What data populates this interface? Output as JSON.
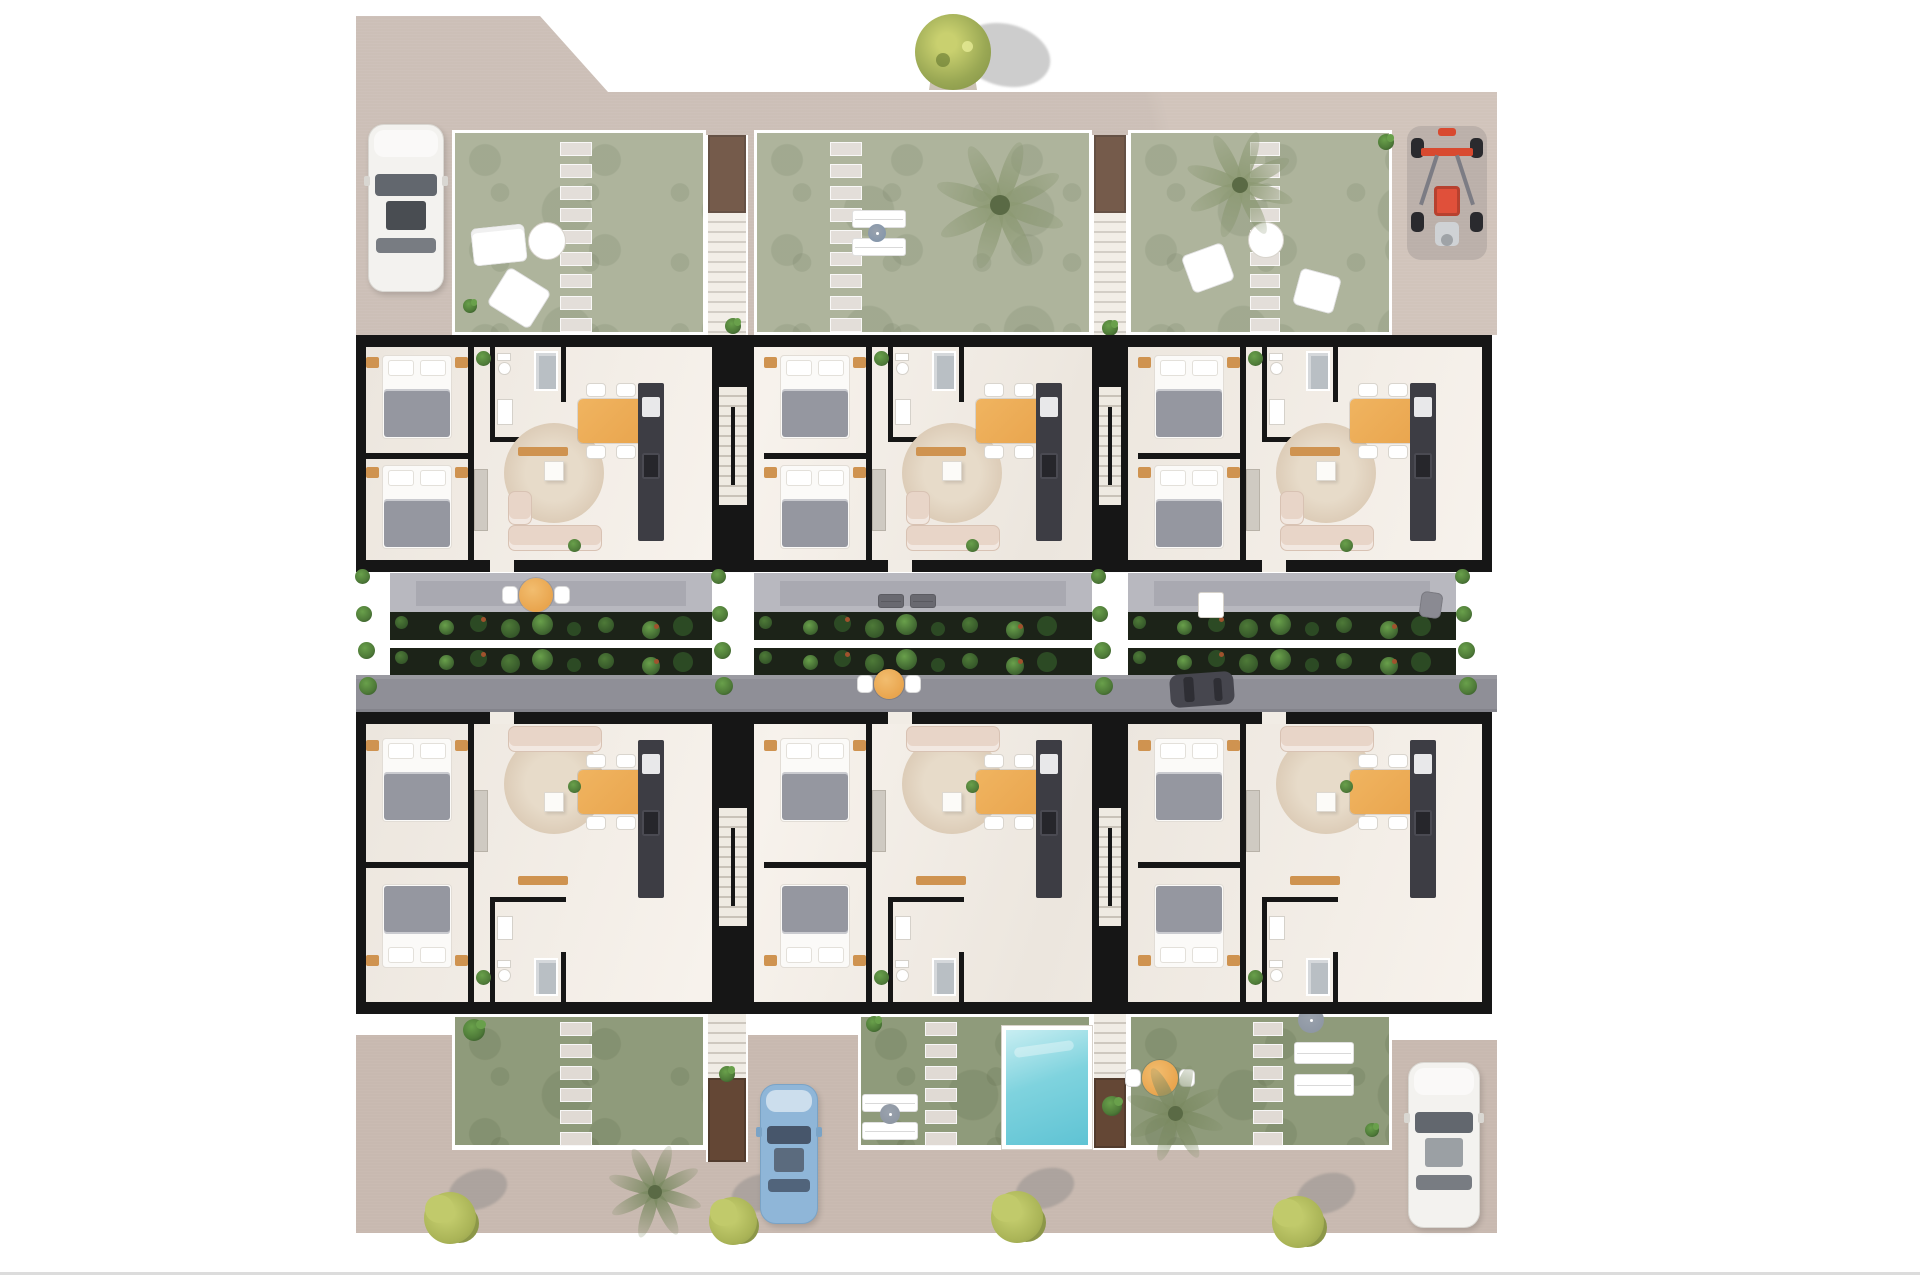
{
  "meta": {
    "description": "aerial-3d-floor-plan-render-of-two-row-residential-complex",
    "canvas": {
      "w": 1920,
      "h": 1280,
      "bg": "#ffffff"
    }
  },
  "palette": {
    "pavementTop": "#c6b6ab",
    "pavementBottom": "#c2b2a7",
    "gardenTop": "#9aa284",
    "gardenBottom": "#83906c",
    "gardenSpot": "rgba(45,62,28,0.14)",
    "stone": "#ddd6d0",
    "wall": "#161616",
    "floorA": "#ece6de",
    "floorB": "#f7f2ec",
    "terrace": "#b8b8bf",
    "terraceInner": "#a9a9b1",
    "street": "#8f8f97",
    "planterBase": "#1c2318",
    "plant1": "#4e7a38",
    "plant2": "#69a04b",
    "plant3": "#2c4a24",
    "plantAccent": "#a0522d",
    "poolHi": "#c8eef2",
    "poolMid": "#7fd3de",
    "poolLo": "#5fc3d4",
    "orange": "#e9a54e",
    "rug": "#dbcab5",
    "rugHi": "#e7dbc9",
    "sofa": "#e8d5c8",
    "blanket": "#9597a0",
    "sheet": "#fbfaf8",
    "nightstand": "#cf9350",
    "kitchen": "#3d3d44",
    "brown": "#53331f",
    "brownDark": "#3f2617",
    "tread": "#efeae2",
    "treadLine": "#c9c2b8",
    "carWhite": "#f3f2ef",
    "carBlue": "#8fb6d8",
    "carDark": "#46464e",
    "glass": "#62676e",
    "glassDark": "#494d52",
    "buggyRed": "#d84a30",
    "buggyFrame": "#7c7c84",
    "palmTop": "#8d9a74",
    "palmBottom": "#7b8a62",
    "palmCore": "#5a6a45",
    "bushMain": "#aab457",
    "bushHi": "#c1ca6b",
    "bushLo": "#8c9748",
    "treeHi": "#c9d06f",
    "treeMid": "#9aa854",
    "treeLo": "#7e8e44",
    "shadow": "rgba(130,130,130,0.40)",
    "washTop": "rgba(255,255,255,0.20)",
    "washBottom": "rgba(255,255,255,0.10)",
    "white": "#ffffff",
    "loungerGray": "#696970",
    "parasolA": "#9aa2ad",
    "parasolB": "#6f7780"
  },
  "scene": {
    "pavements": [
      {
        "name": "pavement-top",
        "color": "#c6b6ab",
        "points": "356,16 540,16 608,92 1497,92 1497,335 356,335"
      },
      {
        "name": "pavement-bottom",
        "color": "#c2b2a7",
        "points": "356,1035 452,1035 452,1150 748,1150 748,1035 858,1035 858,1150 1392,1150 1392,1040 1497,1040 1497,1233 356,1233"
      }
    ],
    "washes": [
      {
        "name": "sun-wash-top",
        "x": 350,
        "y": 10,
        "w": 1155,
        "h": 330,
        "color": "rgba(255,255,255,0.20)"
      },
      {
        "name": "sun-wash-bottom",
        "x": 350,
        "y": 1014,
        "w": 1155,
        "h": 222,
        "color": "rgba(255,255,255,0.10)"
      }
    ],
    "gardens": [
      {
        "name": "garden-top-1",
        "x": 452,
        "y": 130,
        "w": 254,
        "h": 205,
        "tone": "top",
        "stones": {
          "x": 560,
          "w": 32,
          "y0": 142,
          "count": 9,
          "sh": 14,
          "gap": 8
        }
      },
      {
        "name": "garden-top-2",
        "x": 754,
        "y": 130,
        "w": 338,
        "h": 205,
        "tone": "top",
        "stones": {
          "x": 830,
          "w": 32,
          "y0": 142,
          "count": 9,
          "sh": 14,
          "gap": 8
        }
      },
      {
        "name": "garden-top-3",
        "x": 1128,
        "y": 130,
        "w": 264,
        "h": 205,
        "tone": "top",
        "stones": {
          "x": 1250,
          "w": 30,
          "y0": 142,
          "count": 9,
          "sh": 14,
          "gap": 8
        }
      },
      {
        "name": "garden-bottom-1",
        "x": 452,
        "y": 1014,
        "w": 254,
        "h": 134,
        "tone": "bottom",
        "stones": {
          "x": 560,
          "w": 32,
          "y0": 1022,
          "count": 6,
          "sh": 14,
          "gap": 8
        }
      },
      {
        "name": "garden-bottom-2",
        "x": 858,
        "y": 1014,
        "w": 234,
        "h": 134,
        "tone": "bottom",
        "stones": {
          "x": 925,
          "w": 32,
          "y0": 1022,
          "count": 6,
          "sh": 14,
          "gap": 8
        }
      },
      {
        "name": "garden-bottom-3",
        "x": 1128,
        "y": 1014,
        "w": 264,
        "h": 134,
        "tone": "bottom",
        "stones": {
          "x": 1253,
          "w": 30,
          "y0": 1022,
          "count": 6,
          "sh": 14,
          "gap": 8
        }
      }
    ],
    "stairs": [
      {
        "name": "stairs-top-left",
        "x": 706,
        "w": 42,
        "landing": {
          "y": 135,
          "h": 78
        },
        "treads": {
          "y": 213,
          "h": 122
        }
      },
      {
        "name": "stairs-top-right",
        "x": 1092,
        "w": 36,
        "landing": {
          "y": 135,
          "h": 78
        },
        "treads": {
          "y": 213,
          "h": 122
        }
      },
      {
        "name": "stairs-bottom-left",
        "x": 706,
        "w": 42,
        "treads": {
          "y": 1014,
          "h": 64
        },
        "landing": {
          "y": 1078,
          "h": 84
        }
      },
      {
        "name": "stairs-bottom-right",
        "x": 1092,
        "w": 36,
        "treads": {
          "y": 1014,
          "h": 64
        },
        "landing": {
          "y": 1078,
          "h": 70
        }
      }
    ],
    "pool": {
      "name": "pool",
      "x": 1006,
      "y": 1030,
      "w": 82,
      "h": 115,
      "rim": 4
    },
    "garden_props": [
      {
        "type": "sofa_small",
        "name": "garden-sofa",
        "x": 472,
        "y": 226,
        "w": 54,
        "h": 38,
        "rot": -6
      },
      {
        "type": "table_round_white",
        "name": "garden-table",
        "cx": 547,
        "cy": 241,
        "d": 38
      },
      {
        "type": "chair",
        "name": "garden-chair",
        "x": 494,
        "y": 276,
        "w": 50,
        "h": 44,
        "rot": 32
      },
      {
        "type": "plant",
        "name": "garden-shrub",
        "cx": 470,
        "cy": 306,
        "d": 14
      },
      {
        "type": "lounger",
        "name": "sun-lounger",
        "x": 852,
        "y": 210,
        "w": 54,
        "h": 18
      },
      {
        "type": "lounger",
        "name": "sun-lounger",
        "x": 852,
        "y": 238,
        "w": 54,
        "h": 18
      },
      {
        "type": "parasol",
        "name": "parasol",
        "cx": 877,
        "cy": 233,
        "d": 18,
        "color": "#7d92aa"
      },
      {
        "type": "table_round_white",
        "name": "garden-table",
        "cx": 1266,
        "cy": 240,
        "d": 36
      },
      {
        "type": "chair",
        "name": "garden-chair",
        "x": 1186,
        "y": 248,
        "w": 44,
        "h": 40,
        "rot": -20
      },
      {
        "type": "chair",
        "name": "garden-chair",
        "x": 1296,
        "y": 272,
        "w": 42,
        "h": 38,
        "rot": 15
      },
      {
        "type": "plant",
        "name": "garden-shrub",
        "cx": 1386,
        "cy": 142,
        "d": 16
      },
      {
        "type": "plant",
        "name": "entry-plant",
        "cx": 733,
        "cy": 326,
        "d": 16
      },
      {
        "type": "plant",
        "name": "entry-plant",
        "cx": 1110,
        "cy": 328,
        "d": 16
      },
      {
        "type": "lounger",
        "name": "sun-lounger",
        "x": 862,
        "y": 1094,
        "w": 56,
        "h": 18
      },
      {
        "type": "lounger",
        "name": "sun-lounger",
        "x": 862,
        "y": 1122,
        "w": 56,
        "h": 18
      },
      {
        "type": "parasol",
        "name": "parasol",
        "cx": 890,
        "cy": 1114,
        "d": 20,
        "color": "#8a93a0"
      },
      {
        "type": "plant",
        "name": "garden-shrub",
        "cx": 474,
        "cy": 1030,
        "d": 22
      },
      {
        "type": "plant",
        "name": "garden-shrub",
        "cx": 874,
        "cy": 1024,
        "d": 16
      },
      {
        "type": "parasol",
        "name": "parasol",
        "cx": 1311,
        "cy": 1020,
        "d": 26,
        "color": "#8a93a0"
      },
      {
        "type": "lounger",
        "name": "sun-lounger",
        "x": 1294,
        "y": 1042,
        "w": 60,
        "h": 22
      },
      {
        "type": "lounger",
        "name": "sun-lounger",
        "x": 1294,
        "y": 1074,
        "w": 60,
        "h": 22
      },
      {
        "type": "round_table_set",
        "name": "patio-table",
        "cx": 1160,
        "cy": 1078,
        "d": 36,
        "chairs": 2
      },
      {
        "type": "plant",
        "name": "stair-plant",
        "cx": 1112,
        "cy": 1106,
        "d": 20
      },
      {
        "type": "plant",
        "name": "stair-plant",
        "cx": 727,
        "cy": 1074,
        "d": 16
      },
      {
        "type": "plant",
        "name": "garden-shrub",
        "cx": 1372,
        "cy": 1130,
        "d": 14
      }
    ],
    "trees": [
      {
        "type": "roundtree",
        "name": "tree",
        "cx": 953,
        "cy": 52,
        "r": 38
      },
      {
        "type": "palm",
        "name": "palm-tree",
        "cx": 1000,
        "cy": 205,
        "r": 66,
        "tone": "top"
      },
      {
        "type": "palm",
        "name": "palm-tree",
        "cx": 1240,
        "cy": 185,
        "r": 55,
        "tone": "top"
      },
      {
        "type": "palm",
        "name": "palm-tree",
        "cx": 655,
        "cy": 1192,
        "r": 48,
        "tone": "bottom"
      },
      {
        "type": "palm",
        "name": "palm-tree",
        "cx": 1175,
        "cy": 1113,
        "r": 50,
        "tone": "bottom"
      },
      {
        "type": "bush",
        "name": "street-bush",
        "cx": 450,
        "cy": 1218,
        "r": 26
      },
      {
        "type": "bush",
        "name": "street-bush",
        "cx": 733,
        "cy": 1221,
        "r": 24
      },
      {
        "type": "bush",
        "name": "street-bush",
        "cx": 1017,
        "cy": 1217,
        "r": 26
      },
      {
        "type": "bush",
        "name": "street-bush",
        "cx": 1298,
        "cy": 1222,
        "r": 26
      }
    ],
    "cars": [
      {
        "type": "sedan",
        "name": "car-white-top",
        "x": 368,
        "y": 124,
        "w": 76,
        "h": 168,
        "body": "#f3f2ef",
        "edge": "#d9d7d2",
        "glass": "#62676e",
        "sunroof": "#494d52",
        "when": "top"
      },
      {
        "type": "buggy",
        "name": "quad-buggy",
        "x": 1411,
        "y": 128,
        "w": 72,
        "h": 128,
        "when": "top"
      },
      {
        "type": "sedan",
        "name": "car-blue-bottom",
        "x": 760,
        "y": 1084,
        "w": 58,
        "h": 140,
        "body": "#8fb6d8",
        "edge": "#7aa3c6",
        "glass": "#47566b",
        "sunroof": "#5b6b7e",
        "when": "bottom"
      },
      {
        "type": "sedan",
        "name": "car-white-bottom",
        "x": 1408,
        "y": 1062,
        "w": 72,
        "h": 166,
        "body": "#f3f2ef",
        "edge": "#d9d7d2",
        "glass": "#62676e",
        "sunroof": "#9ba0a4",
        "when": "bottom"
      }
    ],
    "building": {
      "rows": [
        {
          "name": "units-row-upper",
          "y": 335,
          "h": 237,
          "wallH": 12,
          "floorY": 347,
          "floorH": 213,
          "template": "upper",
          "units": [
            {
              "x": 356,
              "w": 356
            },
            {
              "x": 754,
              "w": 338
            },
            {
              "x": 1128,
              "w": 364
            }
          ]
        },
        {
          "name": "units-row-lower",
          "y": 712,
          "h": 302,
          "wallH": 12,
          "floorY": 724,
          "floorH": 278,
          "template": "lower",
          "units": [
            {
              "x": 356,
              "w": 356
            },
            {
              "x": 754,
              "w": 338
            },
            {
              "x": 1128,
              "w": 364
            }
          ]
        }
      ],
      "left": 356,
      "right": 1492,
      "sideWall": 10,
      "cores": [
        {
          "x": 712,
          "w": 42
        },
        {
          "x": 1092,
          "w": 36
        }
      ],
      "templates": {
        "upper": [
          {
            "t": "wallv",
            "dx": 112,
            "dy": 12,
            "w": 6,
            "h": 213
          },
          {
            "t": "wallh",
            "dx": 10,
            "dy": 118,
            "w": 102,
            "h": 6
          },
          {
            "t": "wallv",
            "dx": 134,
            "dy": 12,
            "w": 5,
            "h": 95
          },
          {
            "t": "wallh",
            "dx": 134,
            "dy": 102,
            "w": 76,
            "h": 5
          },
          {
            "t": "wallv",
            "dx": 205,
            "dy": 12,
            "w": 5,
            "h": 55
          },
          {
            "t": "rug",
            "dx": 148,
            "dy": 88,
            "d": 100
          },
          {
            "t": "bed",
            "dx": 26,
            "dy": 20,
            "w": 70,
            "h": 84,
            "dir": "s"
          },
          {
            "t": "bed",
            "dx": 26,
            "dy": 130,
            "w": 70,
            "h": 84,
            "dir": "s"
          },
          {
            "t": "wc",
            "dx": 141,
            "dy": 18
          },
          {
            "t": "shower",
            "dx": 178,
            "dy": 16,
            "w": 24,
            "h": 40
          },
          {
            "t": "vanity",
            "dx": 141,
            "dy": 64,
            "w": 16,
            "h": 26
          },
          {
            "t": "wardrobe",
            "dx": 118,
            "dy": 134,
            "w": 14,
            "h": 62
          },
          {
            "t": "console",
            "dx": 162,
            "dy": 112,
            "w": 50,
            "h": 9
          },
          {
            "t": "sofa",
            "dx": 152,
            "dy": 190,
            "w": 94,
            "h": 26
          },
          {
            "t": "sofa",
            "dx": 152,
            "dy": 156,
            "w": 24,
            "h": 34
          },
          {
            "t": "coffee",
            "dx": 188,
            "dy": 126,
            "w": 20,
            "h": 20
          },
          {
            "t": "dining",
            "dx": 222,
            "dy": 64,
            "w": 66,
            "h": 44
          },
          {
            "t": "kitchen",
            "dx": 282,
            "dy": 48,
            "w": 26,
            "h": 158
          },
          {
            "t": "plant",
            "dx": 120,
            "dy": 16,
            "d": 15
          },
          {
            "t": "plant",
            "dx": 212,
            "dy": 204,
            "d": 13
          }
        ],
        "lower": [
          {
            "t": "wallv",
            "dx": 112,
            "dy": 12,
            "w": 6,
            "h": 278
          },
          {
            "t": "wallh",
            "dx": 10,
            "dy": 150,
            "w": 102,
            "h": 6
          },
          {
            "t": "wallh",
            "dx": 134,
            "dy": 185,
            "w": 76,
            "h": 5
          },
          {
            "t": "wallv",
            "dx": 134,
            "dy": 190,
            "w": 5,
            "h": 100
          },
          {
            "t": "wallv",
            "dx": 205,
            "dy": 240,
            "w": 5,
            "h": 50
          },
          {
            "t": "rug",
            "dx": 148,
            "dy": 22,
            "d": 100
          },
          {
            "t": "bed",
            "dx": 26,
            "dy": 26,
            "w": 70,
            "h": 84,
            "dir": "s"
          },
          {
            "t": "bed",
            "dx": 26,
            "dy": 172,
            "w": 70,
            "h": 84,
            "dir": "n"
          },
          {
            "t": "sofa",
            "dx": 152,
            "dy": 14,
            "w": 94,
            "h": 26
          },
          {
            "t": "coffee",
            "dx": 188,
            "dy": 80,
            "w": 20,
            "h": 20
          },
          {
            "t": "dining",
            "dx": 222,
            "dy": 58,
            "w": 66,
            "h": 44
          },
          {
            "t": "kitchen",
            "dx": 282,
            "dy": 28,
            "w": 26,
            "h": 158
          },
          {
            "t": "console",
            "dx": 162,
            "dy": 164,
            "w": 50,
            "h": 9
          },
          {
            "t": "wardrobe",
            "dx": 118,
            "dy": 78,
            "w": 14,
            "h": 62
          },
          {
            "t": "vanity",
            "dx": 141,
            "dy": 204,
            "w": 16,
            "h": 24
          },
          {
            "t": "wc",
            "dx": 141,
            "dy": 248
          },
          {
            "t": "shower",
            "dx": 178,
            "dy": 246,
            "w": 24,
            "h": 38
          },
          {
            "t": "plant",
            "dx": 120,
            "dy": 258,
            "d": 15
          },
          {
            "t": "plant",
            "dx": 212,
            "dy": 68,
            "d": 13
          }
        ]
      }
    },
    "midband": {
      "terraceY": 573,
      "terraceH": 39,
      "terraces": [
        {
          "x": 390,
          "w": 322
        },
        {
          "x": 754,
          "w": 338
        },
        {
          "x": 1128,
          "w": 328
        }
      ],
      "planters": [
        {
          "y": 612,
          "h": 28
        },
        {
          "y": 648,
          "h": 27
        }
      ],
      "street": {
        "x": 356,
        "y": 675,
        "w": 1141,
        "h": 37
      },
      "street_props": [
        {
          "type": "round_table_set",
          "name": "street-table",
          "cx": 889,
          "cy": 684,
          "d": 30,
          "chairs": 2
        },
        {
          "type": "car_top_h",
          "name": "car-dark-street",
          "x": 1170,
          "y": 673,
          "w": 64,
          "h": 33
        }
      ],
      "terrace_props": [
        {
          "type": "round_table_set",
          "name": "terrace-table",
          "cx": 536,
          "cy": 595,
          "d": 34,
          "chairs": 2
        },
        {
          "type": "lounger",
          "name": "terrace-lounger",
          "x": 878,
          "y": 594,
          "w": 26,
          "h": 14,
          "color": "#696970"
        },
        {
          "type": "lounger",
          "name": "terrace-lounger",
          "x": 910,
          "y": 594,
          "w": 26,
          "h": 14,
          "color": "#696970"
        },
        {
          "type": "table_sq",
          "name": "terrace-table-sq",
          "x": 1198,
          "y": 592,
          "w": 26,
          "h": 26
        },
        {
          "type": "chair",
          "name": "terrace-chair",
          "x": 1420,
          "y": 592,
          "w": 22,
          "h": 26,
          "rot": 8,
          "color": "#8a8a92"
        }
      ],
      "tuft_columns": [
        362,
        718,
        1098,
        1462
      ],
      "tuft_ys": [
        576,
        614,
        650,
        686
      ]
    },
    "bottom_line": {
      "name": "image-edge-line",
      "x": 0,
      "y": 1272,
      "w": 1920,
      "h": 3,
      "color": "#dcdcdc"
    }
  }
}
